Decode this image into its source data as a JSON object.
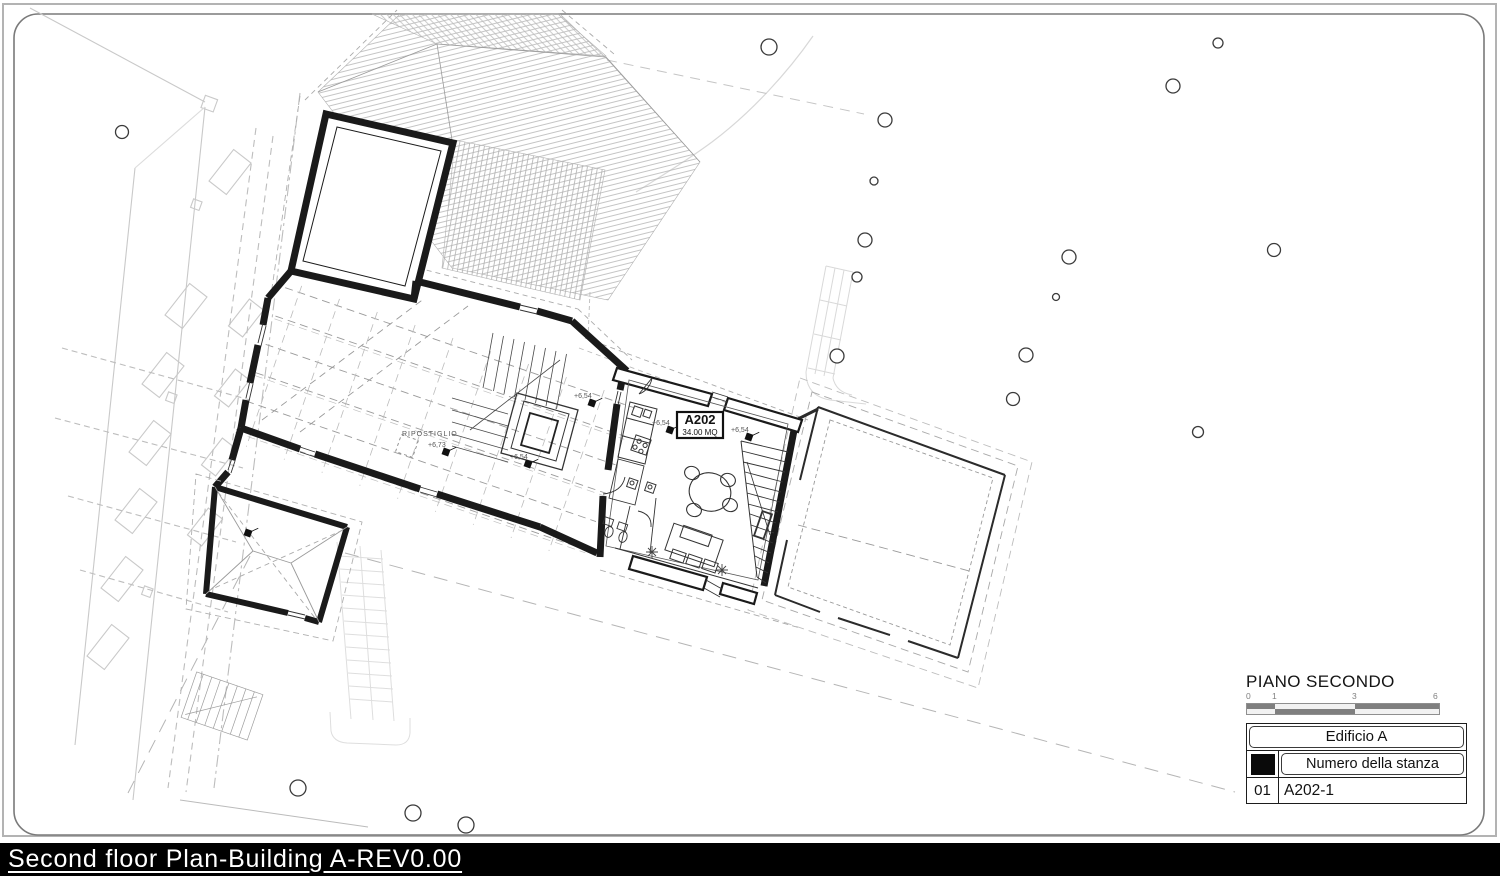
{
  "title_block": {
    "title": "Second floor Plan-Building A-REV0.00"
  },
  "legend": {
    "title": "PIANO SECONDO",
    "scale_ticks": [
      "0",
      "1",
      "3",
      "6"
    ],
    "table": {
      "building": "Edificio A",
      "room_number_header": "Numero della stanza",
      "rows": [
        {
          "id": "01",
          "room": "A202-1"
        }
      ]
    }
  },
  "plan": {
    "rooms": [
      {
        "name": "A202",
        "area": "34.00 MQ"
      },
      {
        "name": "RIPOSTIGLIO"
      }
    ],
    "levels": {
      "l654": "+6,54",
      "l673": "+6,73"
    }
  },
  "colors": {
    "paper": "#ffffff",
    "wall": "#1a1a1a",
    "titlebar_bg": "#000000",
    "titlebar_text": "#ffffff",
    "legend_square": "#0a0a0a",
    "scale_dark": "#7f7f7f",
    "scale_light": "#f2f2f2"
  }
}
